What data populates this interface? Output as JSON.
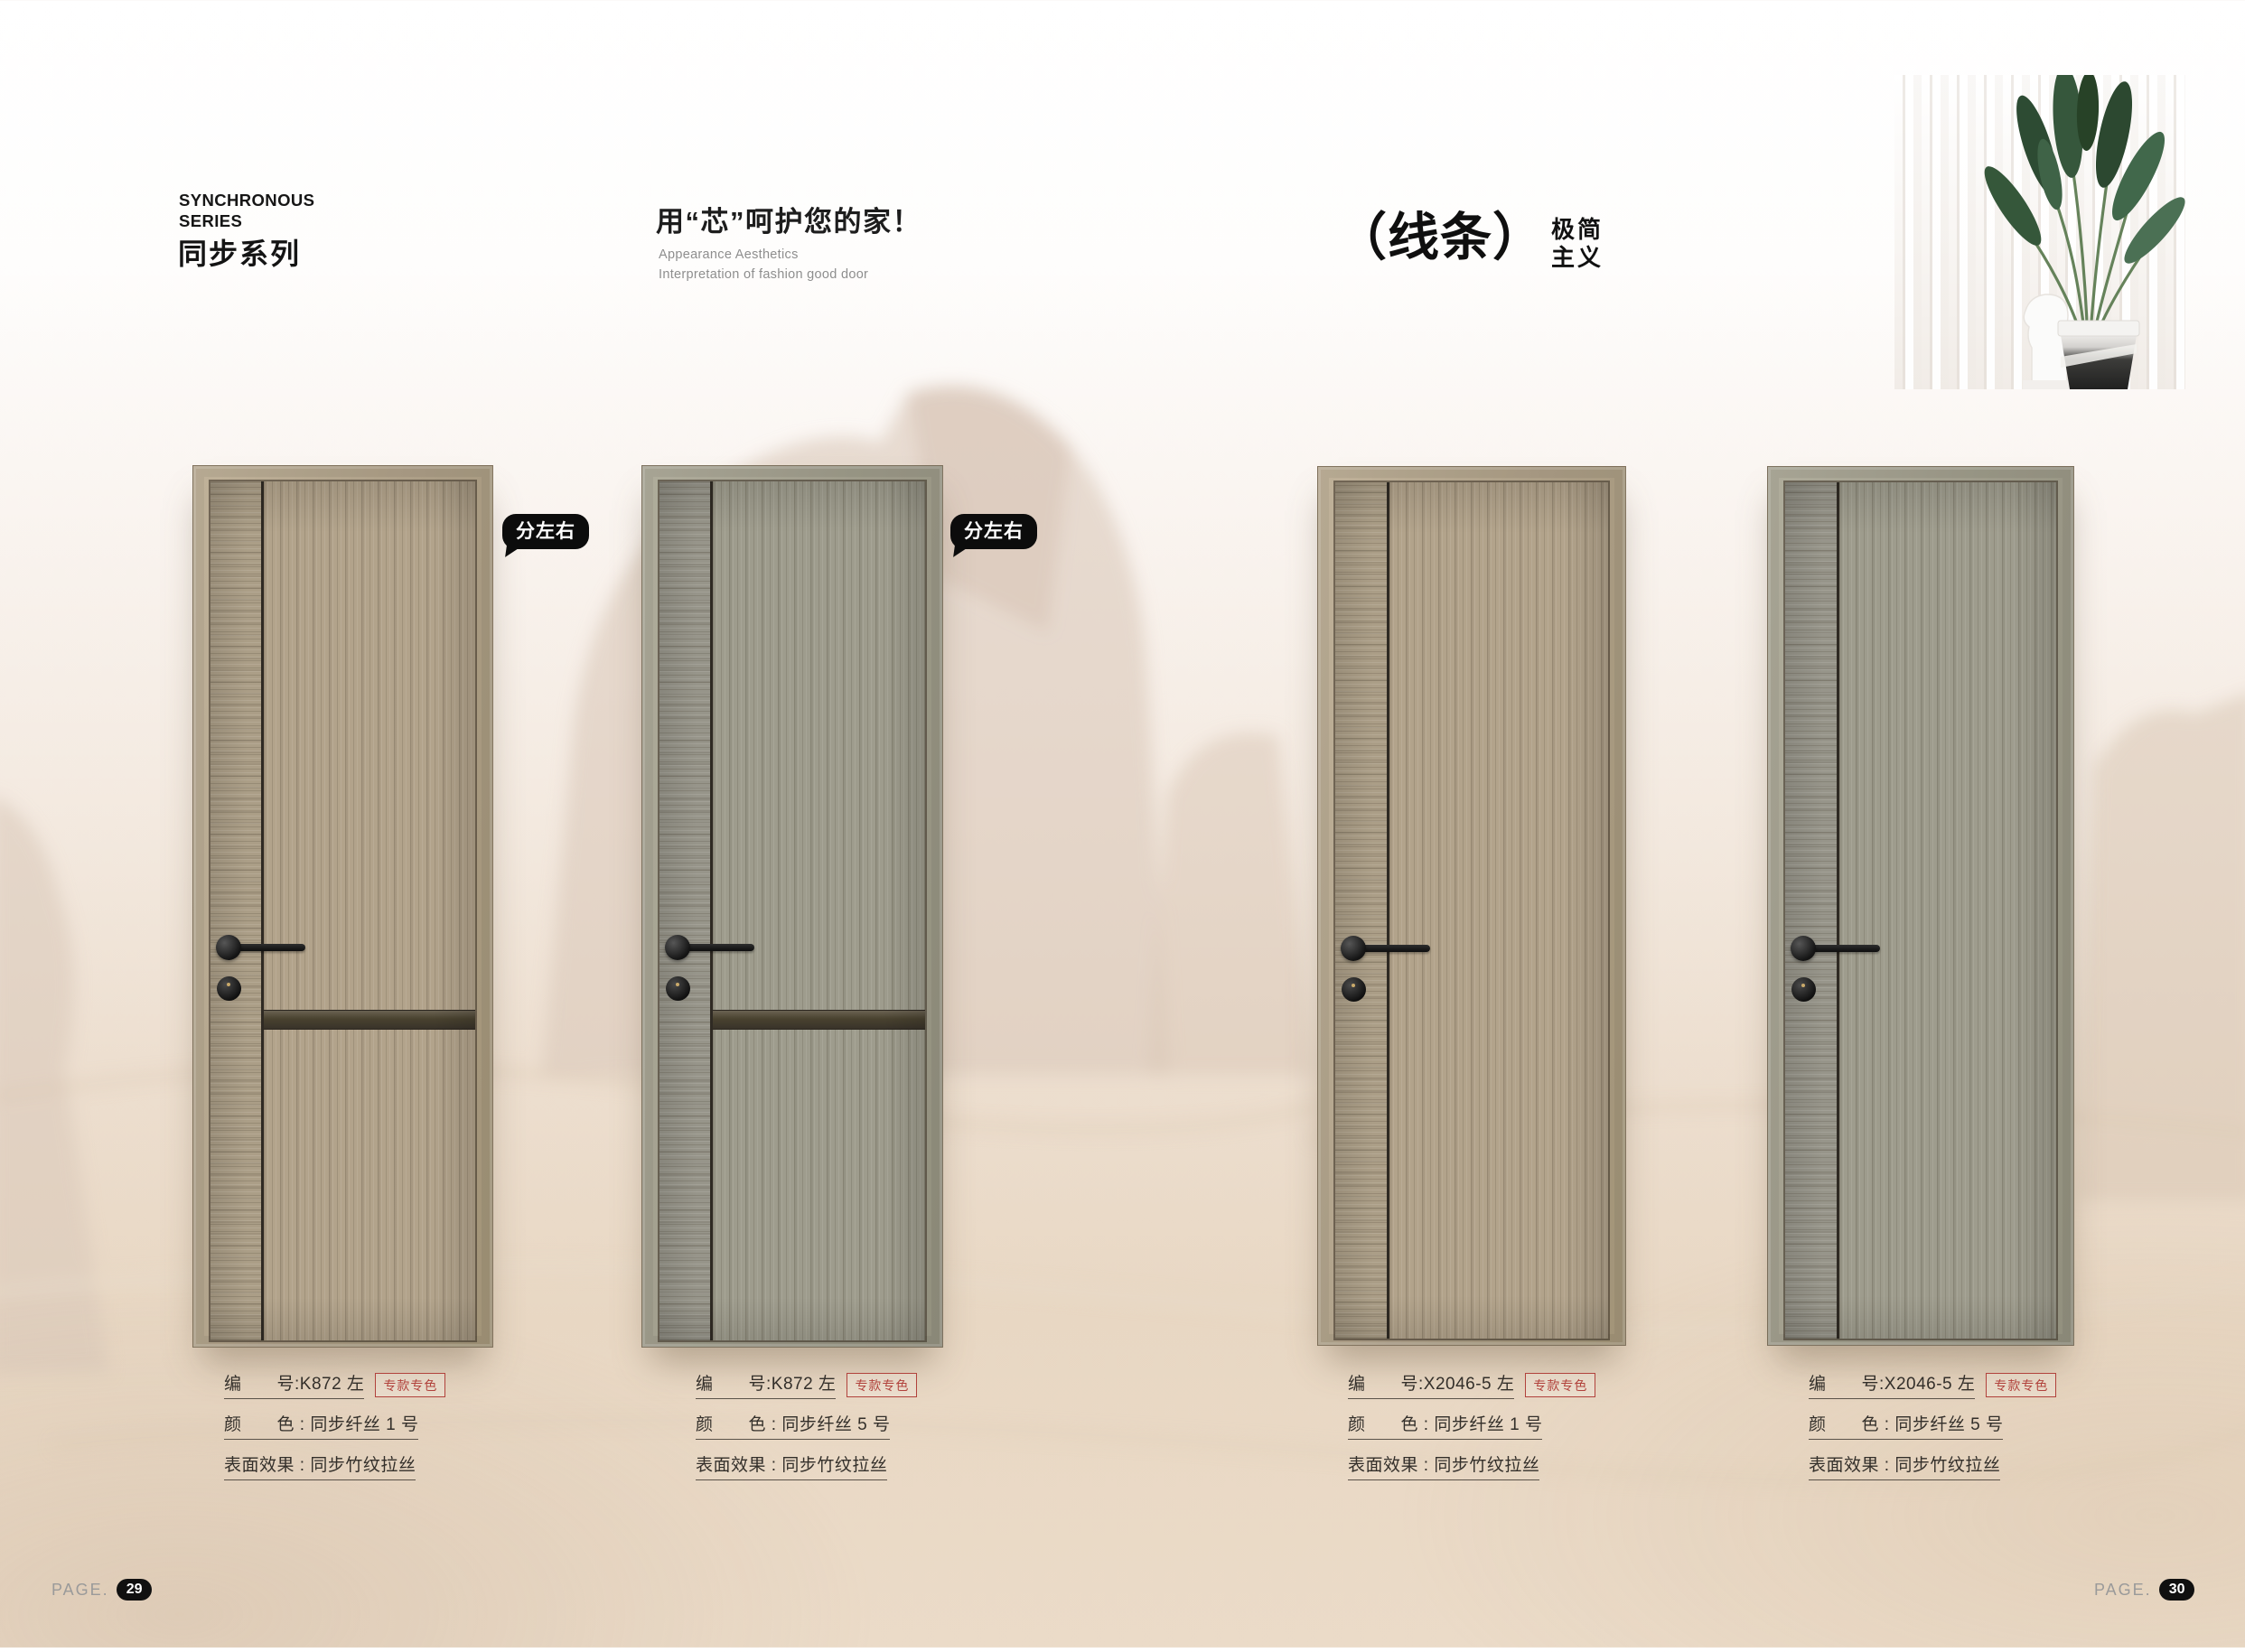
{
  "header": {
    "series_en": "SYNCHRONOUS\nSERIES",
    "series_cn": "同步系列",
    "slogan_cn": "用“芯”呵护您的家！",
    "slogan_en": "Appearance Aesthetics\nInterpretation of fashion good door",
    "style_bracket": "（线条）",
    "style_word_top": "极简",
    "style_word_bottom": "主义"
  },
  "bubble_label": "分左右",
  "doors": [
    {
      "code_label": "编　　号:K872 左",
      "badge": "专款专色",
      "color_label": "颜　　色 : 同步纤丝 1 号",
      "surface_label": "表面效果 : 同步竹纹拉丝",
      "finish": "tan",
      "has_split_bubble": true,
      "has_horizontal_bar": true
    },
    {
      "code_label": "编　　号:K872 左",
      "badge": "专款专色",
      "color_label": "颜　　色 : 同步纤丝 5 号",
      "surface_label": "表面效果 : 同步竹纹拉丝",
      "finish": "sage",
      "has_split_bubble": true,
      "has_horizontal_bar": true
    },
    {
      "code_label": "编　　号:X2046-5 左",
      "badge": "专款专色",
      "color_label": "颜　　色 : 同步纤丝 1 号",
      "surface_label": "表面效果 : 同步竹纹拉丝",
      "finish": "tan",
      "has_split_bubble": false,
      "has_horizontal_bar": false
    },
    {
      "code_label": "编　　号:X2046-5 左",
      "badge": "专款专色",
      "color_label": "颜　　色 : 同步纤丝 5 号",
      "surface_label": "表面效果 : 同步竹纹拉丝",
      "finish": "sage",
      "has_split_bubble": false,
      "has_horizontal_bar": false
    }
  ],
  "footer": {
    "left": {
      "label": "PAGE.",
      "number": "29"
    },
    "right": {
      "label": "PAGE.",
      "number": "30"
    }
  },
  "colors": {
    "badge_red": "#b1423c",
    "finish_tan_panel": "#b2a38b",
    "finish_tan_strip": "#ab9e87",
    "finish_sage_panel": "#9e9c8d",
    "finish_sage_strip": "#97958a",
    "divider_dark": "#2f2a23",
    "page_pill_black": "#101010",
    "sand_beige": "#e8d7c3"
  }
}
